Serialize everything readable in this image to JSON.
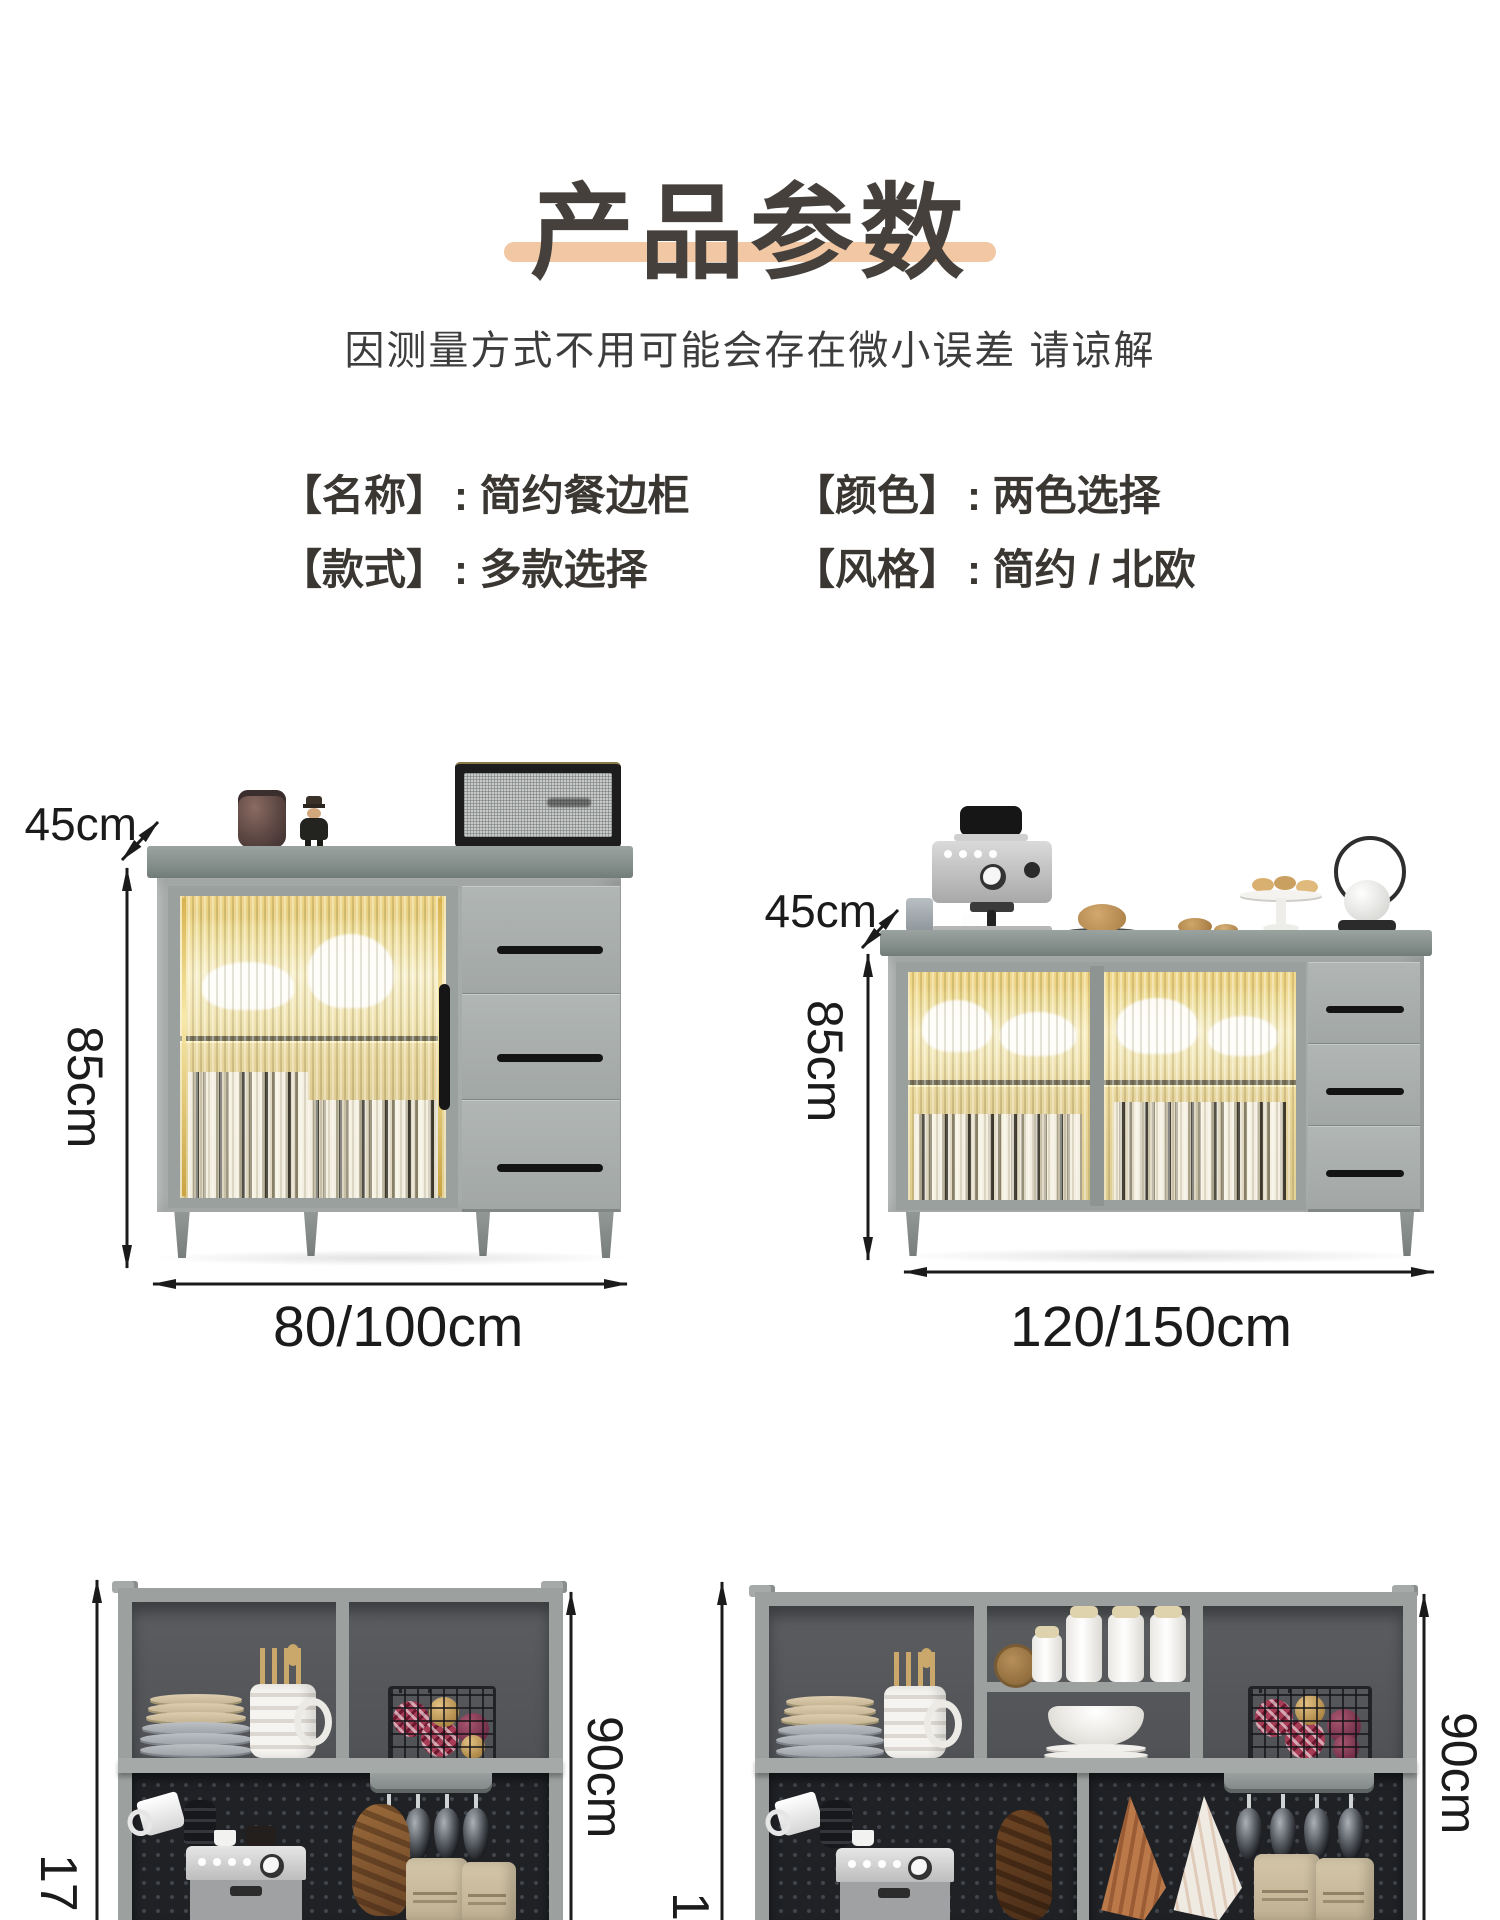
{
  "header": {
    "title": "产品参数",
    "subtitle": "因测量方式不用可能会存在微小误差 请谅解"
  },
  "specs": [
    {
      "label": "【名称】",
      "value": ": 简约餐边柜"
    },
    {
      "label": "【颜色】",
      "value": ": 两色选择"
    },
    {
      "label": "【款式】",
      "value": ": 多款选择"
    },
    {
      "label": "【风格】",
      "value": ": 简约 / 北欧"
    }
  ],
  "dimensions": {
    "small_sideboard": {
      "depth": "45cm",
      "height": "85cm",
      "width": "80/100cm"
    },
    "large_sideboard": {
      "depth": "45cm",
      "height": "85cm",
      "width": "120/150cm"
    },
    "tall_cabinet_left": {
      "upper_height": "90cm",
      "total_height_partial": "17"
    },
    "tall_cabinet_right": {
      "upper_height": "90cm",
      "total_height_partial": "1"
    }
  },
  "colors": {
    "accent_underline": "#f2c8a4",
    "dimension_text": "#1b1b1b",
    "body_text": "#3a3733",
    "cabinet_gray": "#a7acab",
    "pegboard_dark": "#1f2125"
  }
}
